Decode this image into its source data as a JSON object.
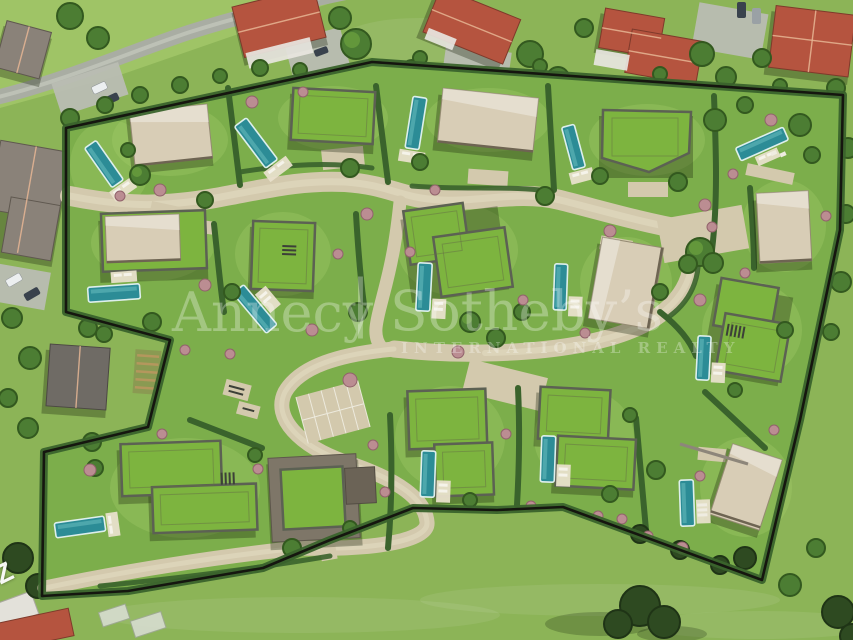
{
  "watermark": {
    "brand_left": "Annecy",
    "separator": "|",
    "brand_right": "Sotheby’s",
    "subtitle": "INTERNATIONAL REALTY"
  },
  "map_label": {
    "text": "Z"
  },
  "palette": {
    "estate_grass": "#7cae4b",
    "outside_meadow": "#8cb457",
    "road_inner": "#d3c9ad",
    "road_outer": "#a9ada3",
    "pool_water": "#2c8c96",
    "roof_beige": "#d8cdb6",
    "roof_green": "#7db43f",
    "hedge": "#3a632c",
    "boundary": "#15160f",
    "roof_red": "#b5543f",
    "roof_grey": "#8a8279"
  },
  "scene": {
    "villa_count": 16,
    "pool_count": 14
  }
}
